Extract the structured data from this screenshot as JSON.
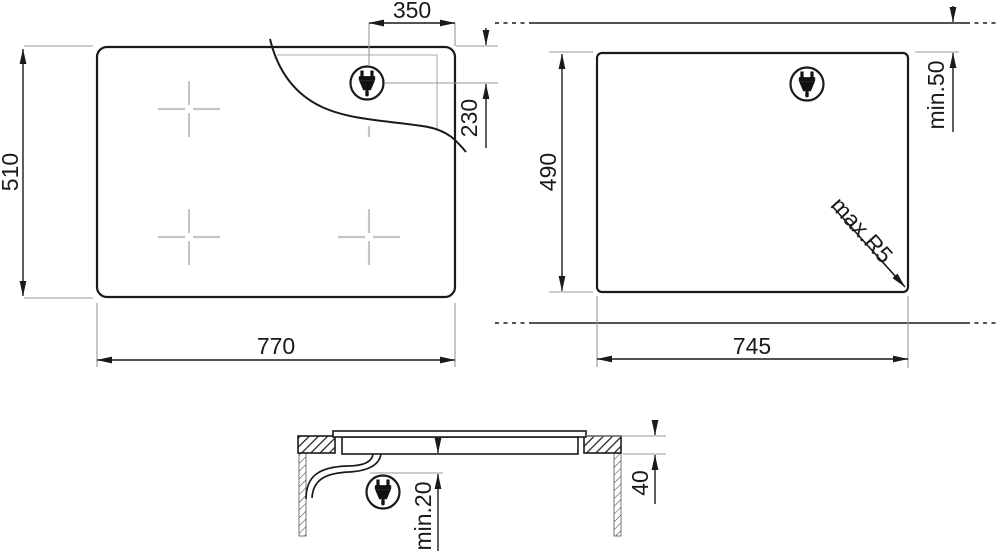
{
  "views": {
    "plan": {
      "title": "hob top view",
      "width": "770",
      "height": "510",
      "plug_offset_from_right": "350",
      "plug_offset_from_top": "230"
    },
    "cutout": {
      "title": "worktop cutout view",
      "width": "745",
      "height": "490",
      "min_distance_to_edge": "min.50",
      "max_corner_radius": "max.R5"
    },
    "section": {
      "title": "side section view",
      "hob_body_height": "40",
      "min_clearance_below": "min.20"
    }
  },
  "icons": {
    "plug": "power-plug"
  },
  "colors": {
    "line": "#1a1a1a",
    "extension_line": "#999999",
    "marker_gray": "#c5c5c5",
    "background": "#ffffff"
  }
}
